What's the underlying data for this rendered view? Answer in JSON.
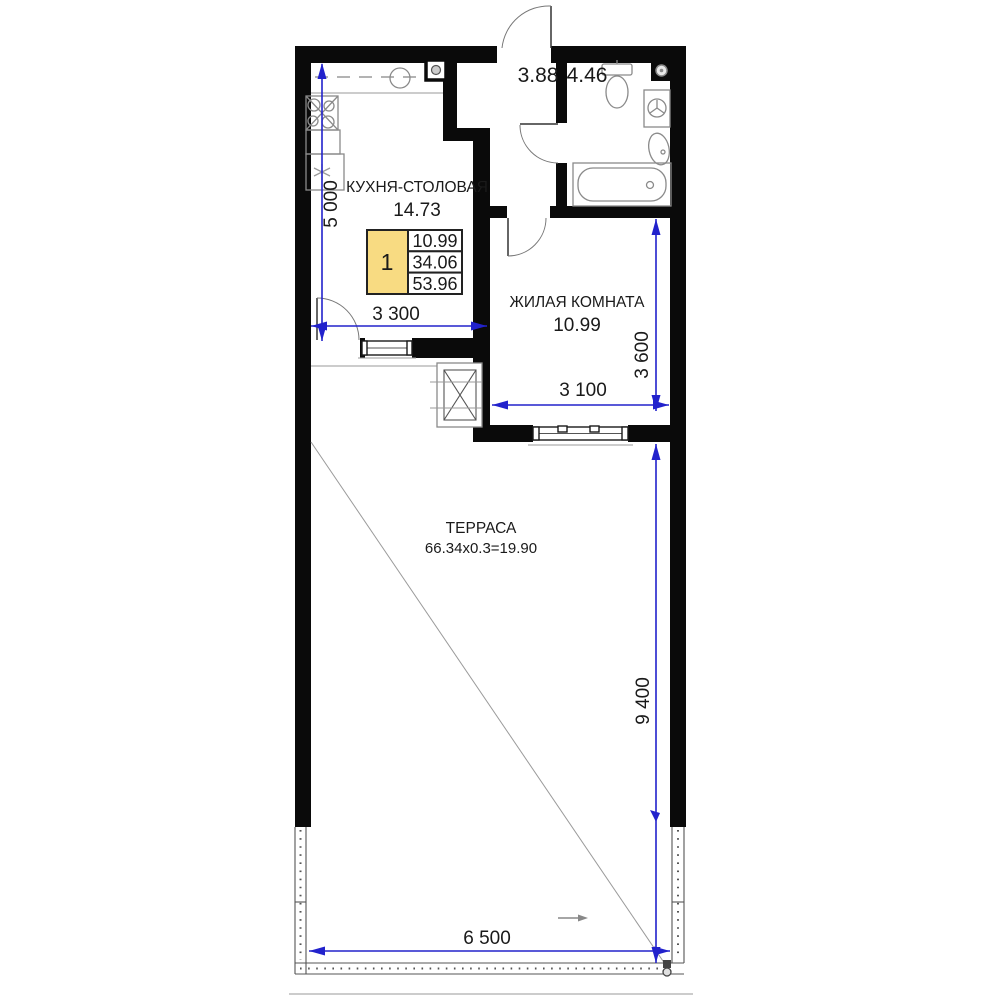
{
  "colors": {
    "dimension_blue": "#2222CC",
    "legend_yellow": "#F8DB82",
    "wall_black": "#0A0A0A"
  },
  "rooms": {
    "kitchen": {
      "name": "КУХНЯ-СТОЛОВАЯ",
      "area": "14.73"
    },
    "hallway": {
      "area": "3.88"
    },
    "bathroom": {
      "area": "4.46"
    },
    "living": {
      "name": "ЖИЛАЯ КОМНАТА",
      "area": "10.99"
    },
    "terrace": {
      "name": "ТЕРРАСА",
      "formula": "66.34x0.3=19.90"
    }
  },
  "dimensions": {
    "kitchen_height": "5 000",
    "kitchen_width": "3 300",
    "living_height": "3 600",
    "living_width": "3 100",
    "terrace_height": "9 400",
    "terrace_width": "6 500"
  },
  "legend": {
    "rooms_count": "1",
    "living_area": "10.99",
    "apartment_area": "34.06",
    "total_area": "53.96"
  }
}
